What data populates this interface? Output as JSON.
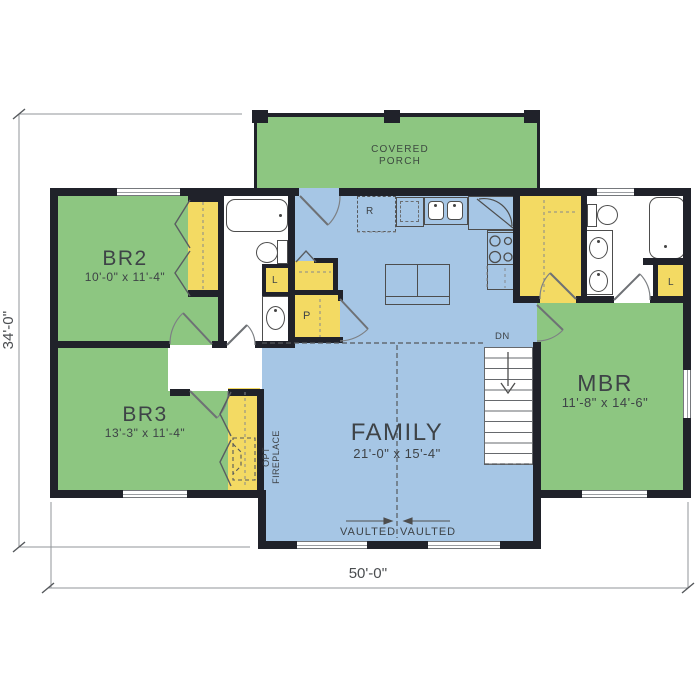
{
  "rooms": {
    "porch": {
      "line1": "COVERED",
      "line2": "PORCH"
    },
    "br2": {
      "name": "BR2",
      "dims": "10'-0\" x 11'-4\""
    },
    "br3": {
      "name": "BR3",
      "dims": "13'-3\" x 11'-4\""
    },
    "family": {
      "name": "FAMILY",
      "dims": "21'-0\" x 15'-4\""
    },
    "mbr": {
      "name": "MBR",
      "dims": "11'-8\" x 14'-6\""
    }
  },
  "labels": {
    "down_stairs": "DN",
    "vaulted_left": "VAULTED",
    "vaulted_right": "VAULTED",
    "opt_fireplace_line1": "OPT",
    "opt_fireplace_line2": "FIREPLACE",
    "linen_hall_bath": "L",
    "linen_master_bath": "L",
    "pantry": "P",
    "refrigerator": "R"
  },
  "dimensions": {
    "overall_width": "50'-0''",
    "overall_height": "34'-0''"
  },
  "colors": {
    "wall": "#20222a",
    "bedroom_green": "#8dc681",
    "family_blue": "#a6c6e5",
    "closet_yellow": "#f3da63",
    "fixture_outline": "#4d4d4d",
    "dimension_gray": "#92959a",
    "label_text": "#3e4347"
  }
}
